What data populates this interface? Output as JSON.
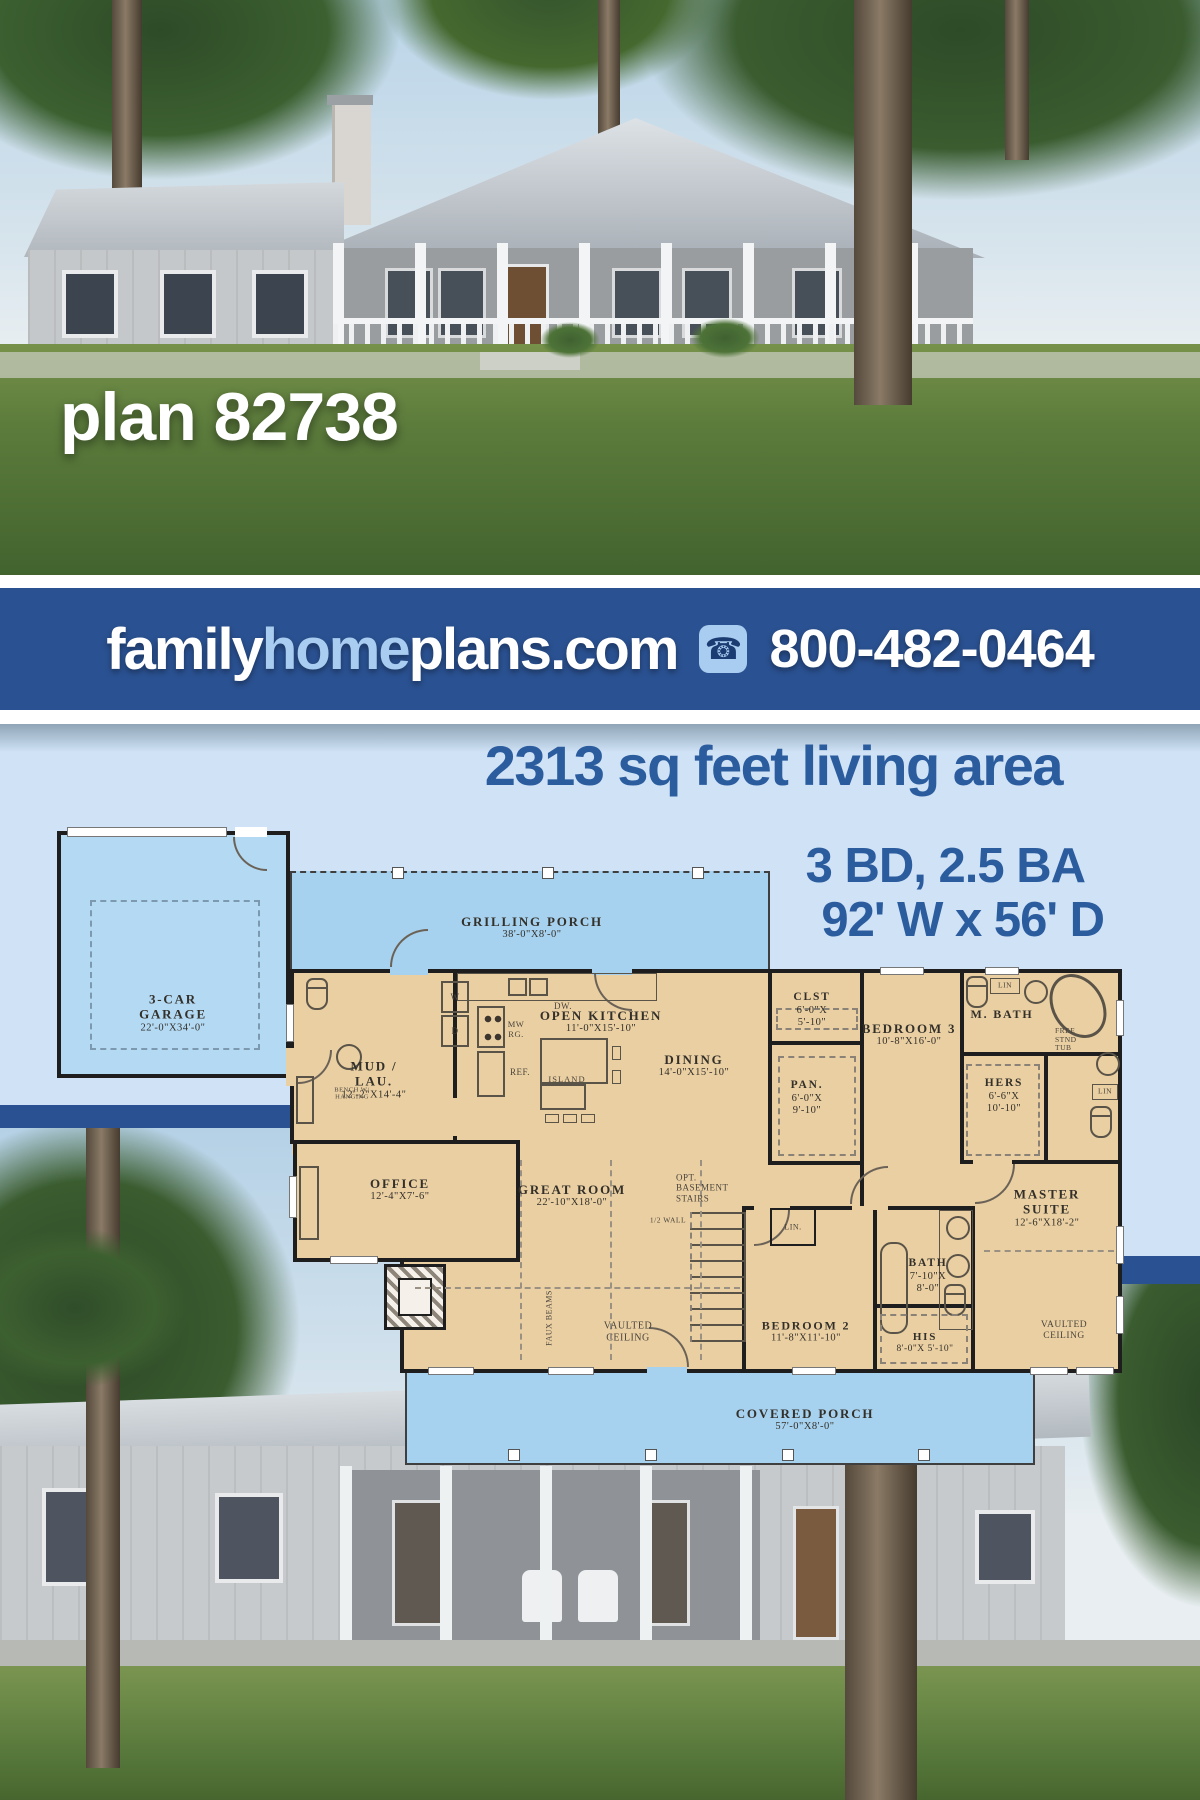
{
  "hero": {
    "caption": "plan 82738"
  },
  "banner": {
    "brand_family": "family",
    "brand_home": "home",
    "brand_plans": "plans.com",
    "phone": "800-482-0464"
  },
  "specs": {
    "living_area": "2313 sq feet living area",
    "beds_baths": "3 BD, 2.5 BA",
    "footprint": "92' W x 56' D"
  },
  "plan": {
    "rooms": [
      {
        "name": "3-CAR GARAGE",
        "dims": "22'-0\"X34'-0\""
      },
      {
        "name": "GRILLING PORCH",
        "dims": "38'-0\"X8'-0\""
      },
      {
        "name": "MUD / LAU.",
        "dims": "12'-2\"X14'-4\""
      },
      {
        "name": "OPEN KITCHEN",
        "dims": "11'-0\"X15'-10\""
      },
      {
        "name": "DINING",
        "dims": "14'-0\"X15'-10\""
      },
      {
        "name": "CLST",
        "dims": "6'-0\"X 5'-10\""
      },
      {
        "name": "PAN.",
        "dims": "6'-0\"X 9'-10\""
      },
      {
        "name": "BEDROOM 3",
        "dims": "10'-8\"X16'-0\""
      },
      {
        "name": "M. BATH",
        "dims": ""
      },
      {
        "name": "HERS",
        "dims": "6'-6\"X 10'-10\""
      },
      {
        "name": "OFFICE",
        "dims": "12'-4\"X7'-6\""
      },
      {
        "name": "GREAT ROOM",
        "dims": "22'-10\"X18'-0\""
      },
      {
        "name": "BEDROOM 2",
        "dims": "11'-8\"X11'-10\""
      },
      {
        "name": "BATH",
        "dims": "7'-10\"X 8'-0\""
      },
      {
        "name": "HIS",
        "dims": "8'-0\"X 5'-10\""
      },
      {
        "name": "MASTER SUITE",
        "dims": "12'-6\"X18'-2\""
      },
      {
        "name": "COVERED PORCH",
        "dims": "57'-0\"X8'-0\""
      }
    ],
    "annotations": {
      "dw": "DW.",
      "mwrg": "MW RG.",
      "ref": "REF.",
      "island": "ISLAND",
      "washer": "W",
      "dryer": "D",
      "bench": "BENCH W/ HANGING",
      "stairs": "OPT. BASEMENT STAIRS",
      "half_wall": "1/2 WALL",
      "faux_beams": "FAUX BEAMS",
      "vaulted": "VAULTED CEILING",
      "lin": "LIN.",
      "lin_short": "LIN",
      "free_tub": "FREE STND TUB"
    }
  },
  "colors": {
    "banner_blue": "#2a5191",
    "headline_blue": "#2b5c9e",
    "panel_blue": "#cfe2f6",
    "plan_blue": "#a7d2ef",
    "plan_tan": "#eacfa2",
    "wall_black": "#1e1e1e"
  }
}
